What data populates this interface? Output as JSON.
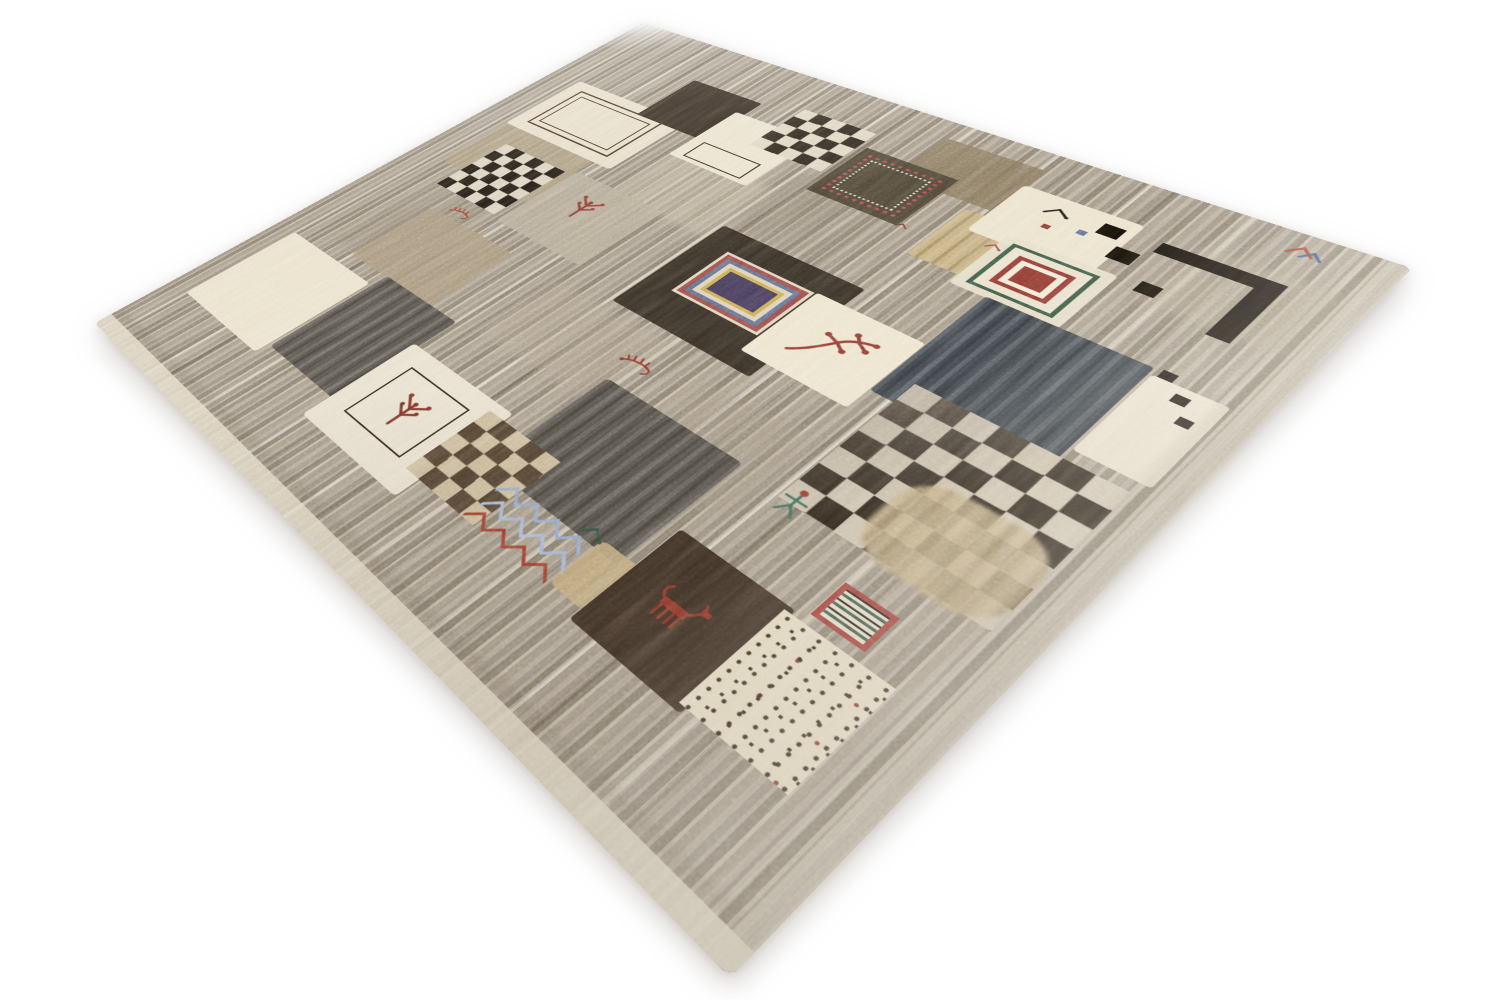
{
  "scene": {
    "alt": "Photograph of a hand-knotted Gabbeh-style wool rug displayed at an angle on a white background. The gray-taupe striated field holds a central patchwork of cream, black, charcoal and tan squares with checkerboards, concentric-square medallions, dotted squares and small tribal motifs: plants, birds, scorpions, a human figure, zigzag lines and animals in maroon, green, blue and gold.",
    "background_color": "#ffffff"
  },
  "rug": {
    "corners_px": {
      "top": [
        643,
        23
      ],
      "right": [
        1412,
        268
      ],
      "bottom": [
        730,
        978
      ],
      "left": [
        95,
        323
      ]
    },
    "palette": {
      "field_base": "#a79b8a",
      "cream": "#e9e0c9",
      "black": "#1f1810",
      "charcoal": "#514c45",
      "navy": "#3e4449",
      "maroon": "#8e3a32",
      "green": "#3d5743",
      "blue": "#5d6a88",
      "light_blue": "#8fa6c8",
      "gold": "#c3ab7a",
      "tan": "#a79478"
    },
    "field": {
      "base": "#a79b8a",
      "stripes": [
        "#9a8f7f",
        "#b3a795",
        "#887d6d",
        "#c2b7a4",
        "#a39784"
      ]
    },
    "patches": [
      {
        "name": "abrash-tint-1",
        "type": "block",
        "x": 300,
        "y": 255,
        "w": 150,
        "h": 130,
        "color": "#c7bba3",
        "opacity": 0.5,
        "blur": 6
      },
      {
        "name": "abrash-tint-2",
        "type": "block",
        "x": 95,
        "y": 470,
        "w": 115,
        "h": 215,
        "color": "#978b77",
        "opacity": 0.45,
        "blur": 6
      },
      {
        "name": "abrash-tint-3",
        "type": "block",
        "x": 380,
        "y": 555,
        "w": 175,
        "h": 125,
        "color": "#b0a28b",
        "opacity": 0.45,
        "blur": 6
      },
      {
        "name": "abrash-tint-4",
        "type": "block",
        "x": 455,
        "y": 205,
        "w": 125,
        "h": 145,
        "color": "#8f8270",
        "opacity": 0.4,
        "blur": 6
      },
      {
        "name": "abrash-tint-5",
        "type": "block",
        "x": 850,
        "y": 80,
        "w": 125,
        "h": 120,
        "color": "#b5a88f",
        "opacity": 0.45,
        "blur": 6
      },
      {
        "name": "abrash-tint-6",
        "type": "block",
        "x": 615,
        "y": 575,
        "w": 130,
        "h": 130,
        "color": "#a39681",
        "opacity": 0.4,
        "blur": 6
      },
      {
        "name": "tan-block",
        "type": "block",
        "x": 60,
        "y": 330,
        "w": 170,
        "h": 140,
        "color": "#a99878",
        "opacity": 0.8,
        "radius": 8
      },
      {
        "name": "frame-patch",
        "type": "block",
        "x": 55,
        "y": 195,
        "w": 205,
        "h": 150,
        "color": "#e6ddc6",
        "opacity": 0.97,
        "radius": 5
      },
      {
        "name": "double-frame-motif",
        "type": "medallion",
        "x": 78,
        "y": 215,
        "w": 158,
        "h": 110,
        "rings": [
          [
            3,
            "#45311f"
          ],
          [
            9,
            "rgba(0,0,0,0)"
          ],
          [
            2,
            "#45311f"
          ]
        ],
        "center": "rgba(0,0,0,0)"
      },
      {
        "name": "black-square-top",
        "type": "block",
        "x": 190,
        "y": 98,
        "w": 118,
        "h": 120,
        "color": "#342a20",
        "radius": 4
      },
      {
        "name": "cream-square-top",
        "type": "block",
        "x": 295,
        "y": 135,
        "w": 125,
        "h": 135,
        "color": "#e8e0ca",
        "radius": 4
      },
      {
        "name": "outline-rect",
        "type": "outline",
        "x": 312,
        "y": 220,
        "w": 92,
        "h": 42,
        "borderWidth": 2,
        "borderColor": "#3a2a1a"
      },
      {
        "name": "checkerboard-top",
        "type": "checker",
        "x": 362,
        "y": 78,
        "w": 108,
        "h": 112,
        "cells": 5,
        "color": "#2e261d",
        "color2": "#ddd3bd"
      },
      {
        "name": "brown-patch-top",
        "type": "block",
        "x": 540,
        "y": 38,
        "w": 125,
        "h": 108,
        "color": "#84735a",
        "opacity": 0.92,
        "radius": 8
      },
      {
        "name": "dotted-square",
        "type": "dotsquare",
        "x": 480,
        "y": 112,
        "w": 122,
        "h": 120,
        "color": "#4c4434",
        "color2": "#b5494a"
      },
      {
        "name": "gold-patch",
        "type": "block",
        "x": 640,
        "y": 158,
        "w": 108,
        "h": 112,
        "color": "#c3ab7a",
        "radius": 6,
        "streak": true
      },
      {
        "name": "house-patch",
        "type": "block",
        "x": 662,
        "y": 78,
        "w": 132,
        "h": 115,
        "color": "#eae1c9",
        "radius": 6
      },
      {
        "name": "black-bird-motif",
        "type": "motif",
        "sym": "sym-bird",
        "x": 700,
        "y": 94,
        "w": 34,
        "h": 26,
        "color": "#1f1812"
      },
      {
        "name": "blue-dot",
        "type": "block",
        "x": 748,
        "y": 122,
        "w": 9,
        "h": 9,
        "color": "#5b6b8c"
      },
      {
        "name": "red-dot",
        "type": "block",
        "x": 716,
        "y": 134,
        "w": 8,
        "h": 8,
        "color": "#8e3a32"
      },
      {
        "name": "l-motif-top",
        "type": "block",
        "x": 820,
        "y": 95,
        "w": 115,
        "h": 21,
        "color": "#17120d"
      },
      {
        "name": "l-motif-side",
        "type": "block",
        "x": 914,
        "y": 95,
        "w": 21,
        "h": 116,
        "color": "#17120d"
      },
      {
        "name": "small-square-a",
        "type": "block",
        "x": 762,
        "y": 96,
        "w": 22,
        "h": 22,
        "color": "#141009"
      },
      {
        "name": "small-square-b",
        "type": "block",
        "x": 790,
        "y": 128,
        "w": 24,
        "h": 24,
        "color": "#141009"
      },
      {
        "name": "small-square-c",
        "type": "block",
        "x": 836,
        "y": 168,
        "w": 20,
        "h": 20,
        "color": "#141009"
      },
      {
        "name": "colorful-bird-motif",
        "type": "motif",
        "sym": "sym-bird2",
        "x": 903,
        "y": 14,
        "w": 42,
        "h": 34,
        "color": "#a03a2c"
      },
      {
        "name": "medallion-backing",
        "type": "block",
        "x": 700,
        "y": 175,
        "w": 116,
        "h": 112,
        "color": "#e5dcc5",
        "opacity": 0.95,
        "radius": 5
      },
      {
        "name": "green-medallion",
        "type": "medallion",
        "x": 712,
        "y": 186,
        "w": 92,
        "h": 90,
        "rings": [
          [
            5,
            "#3d5743"
          ],
          [
            11,
            "#e8dfc8"
          ],
          [
            6,
            "#8e3a32"
          ],
          [
            7,
            "#f0e8d4"
          ]
        ],
        "center": "#8e3a32"
      },
      {
        "name": "taupe-patch-mid",
        "type": "block",
        "x": 230,
        "y": 375,
        "w": 150,
        "h": 145,
        "color": "#b5a994",
        "opacity": 0.85,
        "radius": 6
      },
      {
        "name": "plant-motif-a",
        "type": "motif",
        "sym": "sym-plant",
        "x": 268,
        "y": 402,
        "w": 58,
        "h": 58,
        "color": "#8e3a32"
      },
      {
        "name": "checkerboard-left",
        "type": "checker",
        "x": 100,
        "y": 385,
        "w": 118,
        "h": 128,
        "cells": 6,
        "color": "#231c15",
        "color2": "#d9cfbb"
      },
      {
        "name": "tan-patch-left",
        "type": "block",
        "x": 140,
        "y": 555,
        "w": 160,
        "h": 135,
        "color": "#a79478",
        "opacity": 0.85,
        "radius": 8
      },
      {
        "name": "scorpion-motif-a",
        "type": "motif",
        "sym": "sym-scorpion",
        "x": 160,
        "y": 524,
        "w": 40,
        "h": 28,
        "color": "#a03a2c"
      },
      {
        "name": "medallion-square",
        "type": "block",
        "x": 455,
        "y": 352,
        "w": 190,
        "h": 190,
        "color": "#362e25",
        "radius": 4
      },
      {
        "name": "big-medallion",
        "type": "medallion",
        "x": 492,
        "y": 390,
        "w": 118,
        "h": 96,
        "rings": [
          [
            4,
            "#ddd3ba"
          ],
          [
            6,
            "#9b4a44"
          ],
          [
            6,
            "#5d6a88"
          ],
          [
            6,
            "#d9cfb6"
          ],
          [
            5,
            "#c9a84c"
          ]
        ],
        "center": "#433855"
      },
      {
        "name": "plant-square",
        "type": "block",
        "x": 612,
        "y": 388,
        "w": 127,
        "h": 127,
        "color": "#ece3cb",
        "radius": 4
      },
      {
        "name": "branch-motif",
        "type": "motif",
        "sym": "sym-branch",
        "x": 630,
        "y": 408,
        "w": 92,
        "h": 86,
        "color": "#8e3a32"
      },
      {
        "name": "navy-square",
        "type": "block",
        "x": 740,
        "y": 285,
        "w": 165,
        "h": 195,
        "color": "#3e4449",
        "radius": 4,
        "streak": true
      },
      {
        "name": "cream-tall-patch",
        "type": "block",
        "x": 908,
        "y": 295,
        "w": 66,
        "h": 135,
        "color": "#e7dec8",
        "radius": 4
      },
      {
        "name": "trail-dot-a",
        "type": "block",
        "x": 912,
        "y": 282,
        "w": 13,
        "h": 13,
        "color": "#1c1510"
      },
      {
        "name": "trail-dot-b",
        "type": "block",
        "x": 934,
        "y": 306,
        "w": 13,
        "h": 13,
        "color": "#1c1510"
      },
      {
        "name": "trail-dot-c",
        "type": "block",
        "x": 950,
        "y": 332,
        "w": 12,
        "h": 12,
        "color": "#1c1510"
      },
      {
        "name": "scorpion-motif-b",
        "type": "motif",
        "sym": "sym-scorpion",
        "x": 526,
        "y": 586,
        "w": 46,
        "h": 32,
        "color": "#8e2f28"
      },
      {
        "name": "charcoal-square-mid",
        "type": "block",
        "x": 542,
        "y": 640,
        "w": 175,
        "h": 170,
        "color": "#514c45",
        "radius": 5,
        "streak": true
      },
      {
        "name": "big-checkerboard",
        "type": "checker",
        "x": 765,
        "y": 445,
        "w": 200,
        "h": 205,
        "cells": 7,
        "color": "#261e16",
        "color2": "#cfc3ad",
        "overlay": true
      },
      {
        "name": "tan-streak",
        "type": "block",
        "x": 835,
        "y": 540,
        "w": 130,
        "h": 115,
        "color": "#c0a87c",
        "opacity": 0.88,
        "radius": 40,
        "streak": true,
        "blur": 2
      },
      {
        "name": "person-motif",
        "type": "motif",
        "sym": "sym-person",
        "x": 760,
        "y": 624,
        "w": 38,
        "h": 44,
        "color": "#3e6b5a"
      },
      {
        "name": "red-frame-motif",
        "type": "redframe",
        "x": 862,
        "y": 688,
        "w": 50,
        "h": 46,
        "borderColor": "#9e3b35"
      },
      {
        "name": "cream-square-left",
        "type": "block",
        "x": 38,
        "y": 712,
        "w": 172,
        "h": 172,
        "color": "#e9e0c9",
        "radius": 5
      },
      {
        "name": "darkgray-square-left",
        "type": "block",
        "x": 215,
        "y": 688,
        "w": 135,
        "h": 177,
        "color": "#56514a",
        "radius": 5,
        "streak": true
      },
      {
        "name": "framed-plant-patch",
        "type": "block",
        "x": 342,
        "y": 745,
        "w": 168,
        "h": 158,
        "color": "#e7decb",
        "radius": 5
      },
      {
        "name": "plant-frame",
        "type": "outline",
        "x": 372,
        "y": 772,
        "w": 100,
        "h": 96,
        "borderWidth": 2,
        "borderColor": "#2e2318"
      },
      {
        "name": "plant-motif-b",
        "type": "motif",
        "sym": "sym-plant",
        "x": 392,
        "y": 792,
        "w": 62,
        "h": 60,
        "color": "#7c3026"
      },
      {
        "name": "checkerboard-brown",
        "type": "checker",
        "x": 488,
        "y": 758,
        "w": 106,
        "h": 114,
        "cells": 5,
        "color": "#4e3e2e",
        "color2": "#c9b896"
      },
      {
        "name": "zigzag-blue-1",
        "type": "motif",
        "sym": "sym-zigzag",
        "x": 575,
        "y": 806,
        "w": 112,
        "h": 26,
        "color": "#8fa6c8"
      },
      {
        "name": "zigzag-blue-2",
        "type": "motif",
        "sym": "sym-zigzag",
        "x": 578,
        "y": 828,
        "w": 112,
        "h": 26,
        "color": "#a3b6d4"
      },
      {
        "name": "zigzag-red",
        "type": "motif",
        "sym": "sym-zigzag",
        "x": 576,
        "y": 850,
        "w": 112,
        "h": 24,
        "color": "#a03a2c"
      },
      {
        "name": "gold-patch-bottom",
        "type": "block",
        "x": 690,
        "y": 798,
        "w": 80,
        "h": 68,
        "color": "#c2aa7a",
        "opacity": 0.9,
        "radius": 8
      },
      {
        "name": "small-bird-motif",
        "type": "motif",
        "sym": "sym-bird",
        "x": 664,
        "y": 786,
        "w": 32,
        "h": 26,
        "color": "#2f4a3c"
      },
      {
        "name": "darkbrown-square-bottom",
        "type": "block",
        "x": 730,
        "y": 740,
        "w": 122,
        "h": 140,
        "color": "#3a2d22",
        "radius": 4
      },
      {
        "name": "red-animal-motif",
        "type": "motif",
        "sym": "sym-animal",
        "x": 756,
        "y": 782,
        "w": 64,
        "h": 52,
        "color": "#8e3428"
      },
      {
        "name": "speckled-square",
        "type": "speckle",
        "x": 845,
        "y": 745,
        "w": 102,
        "h": 128,
        "color": "#eadfc4"
      },
      {
        "name": "red-tick-a",
        "type": "motif",
        "sym": "sym-bird",
        "x": 690,
        "y": 196,
        "w": 22,
        "h": 16,
        "color": "#8e3a32"
      },
      {
        "name": "red-tick-b",
        "type": "motif",
        "sym": "sym-bird",
        "x": 598,
        "y": 222,
        "w": 18,
        "h": 14,
        "color": "#6b2d24"
      },
      {
        "name": "edge-shadow-bottom",
        "type": "block",
        "x": 0,
        "y": 960,
        "w": 1000,
        "h": 16,
        "color": "#6f6250",
        "opacity": 0.18,
        "blur": 3
      },
      {
        "name": "edge-shadow-right",
        "type": "block",
        "x": 964,
        "y": 0,
        "w": 14,
        "h": 1000,
        "color": "#6f6250",
        "opacity": 0.14,
        "blur": 3
      },
      {
        "name": "selvedge-bottom",
        "type": "block",
        "x": 0,
        "y": 976,
        "w": 1000,
        "h": 24,
        "color": "#e2d8c3",
        "opacity": 0.85
      },
      {
        "name": "selvedge-right",
        "type": "block",
        "x": 982,
        "y": 0,
        "w": 18,
        "h": 1000,
        "color": "#d8cfbc",
        "opacity": 0.5
      }
    ]
  }
}
